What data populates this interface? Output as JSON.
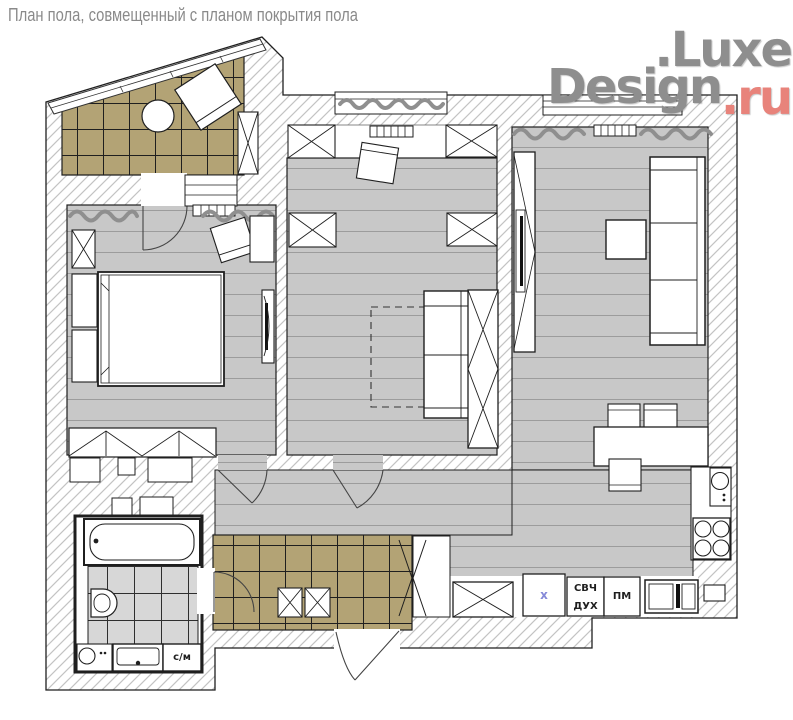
{
  "title": "План пола, совмещенный с планом покрытия пола",
  "logo": {
    "line1": ".Luxe",
    "line2": "Design",
    "suffix": ".ru"
  },
  "appliances": {
    "fridge_mark": "х",
    "microwave": "СВЧ",
    "oven": "ДУХ",
    "dishwasher": "ПМ",
    "washer": "с/м"
  },
  "colors": {
    "tile_tan": "#b3a375",
    "tile_bath": "#d7d7d7",
    "plank_gray": "#c8c8c8",
    "plank_line": "#9c9c9c",
    "hatch_line": "#c3c3c3",
    "outline": "#1f1f1f",
    "curtain_gray": "#8f8f8f",
    "logo_gray": "#8e8e8e",
    "logo_red": "#e8837b",
    "label_blue": "#8589d8",
    "title_gray": "#8a8a8a"
  }
}
